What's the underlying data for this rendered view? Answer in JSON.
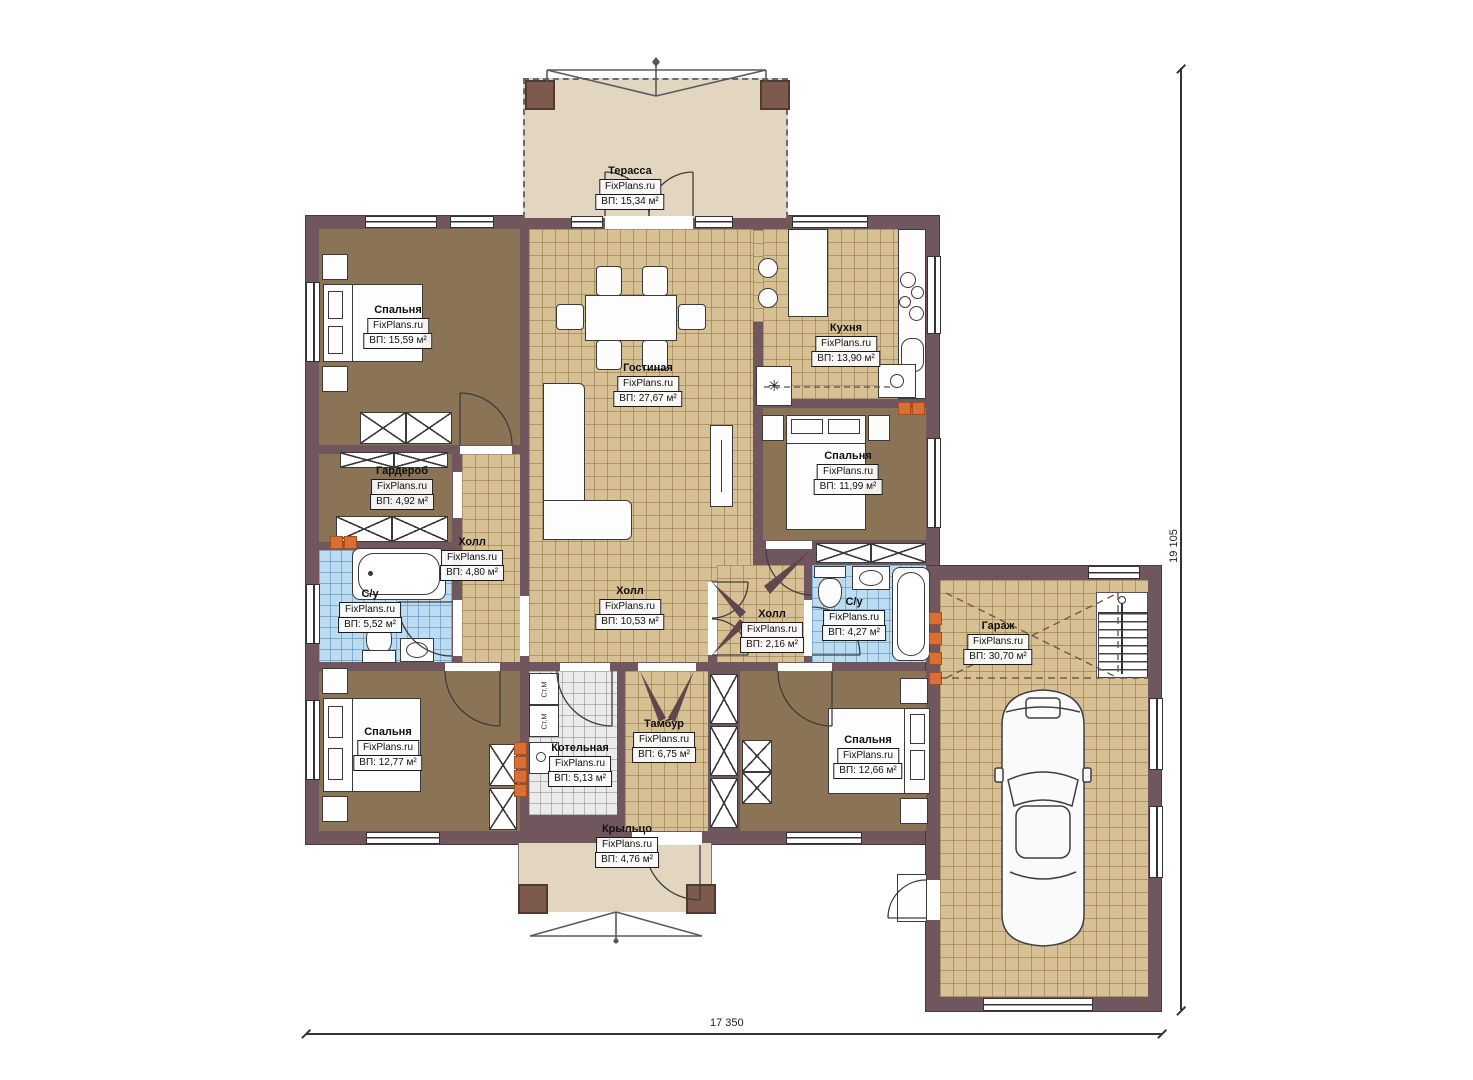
{
  "watermark": "FixPlans.ru",
  "symbols": {
    "stove_asterisk": "✳",
    "washer": "Ст.М"
  },
  "dimensions": {
    "bottom": "17 350",
    "right": "19 105"
  },
  "rooms": {
    "terrace": {
      "name": "Терасса",
      "area": "ВП: 15,34 м²"
    },
    "bedroom_tl": {
      "name": "Спальня",
      "area": "ВП: 15,59 м²"
    },
    "living": {
      "name": "Гостиная",
      "area": "ВП: 27,67 м²"
    },
    "kitchen": {
      "name": "Кухня",
      "area": "ВП: 13,90 м²"
    },
    "bedroom_r": {
      "name": "Спальня",
      "area": "ВП: 11,99 м²"
    },
    "wardrobe": {
      "name": "Гардероб",
      "area": "ВП: 4,92 м²"
    },
    "hall_small": {
      "name": "Холл",
      "area": "ВП: 4,80 м²"
    },
    "bath_left": {
      "name": "С/у",
      "area": "ВП: 5,52 м²"
    },
    "hall_center": {
      "name": "Холл",
      "area": "ВП: 10,53 м²"
    },
    "hall_right": {
      "name": "Холл",
      "area": "ВП: 2,16 м²"
    },
    "bath_right": {
      "name": "С/у",
      "area": "ВП: 4,27 м²"
    },
    "garage": {
      "name": "Гараж",
      "area": "ВП: 30,70 м²"
    },
    "bedroom_bl": {
      "name": "Спальня",
      "area": "ВП: 12,77 м²"
    },
    "boiler": {
      "name": "Котельная",
      "area": "ВП: 5,13 м²"
    },
    "tambour": {
      "name": "Тамбур",
      "area": "ВП: 6,75 м²"
    },
    "bedroom_br": {
      "name": "Спальня",
      "area": "ВП: 12,66 м²"
    },
    "porch": {
      "name": "Крыльцо",
      "area": "ВП: 4,76 м²"
    }
  },
  "colors": {
    "wall": "#6f575d",
    "tile_floor": "#d7c094",
    "bath_tile": "#bcdcf1",
    "bedroom_floor": "#8b7356",
    "terrace_floor": "#e2d6c1",
    "vent_accent": "#d96f35"
  }
}
